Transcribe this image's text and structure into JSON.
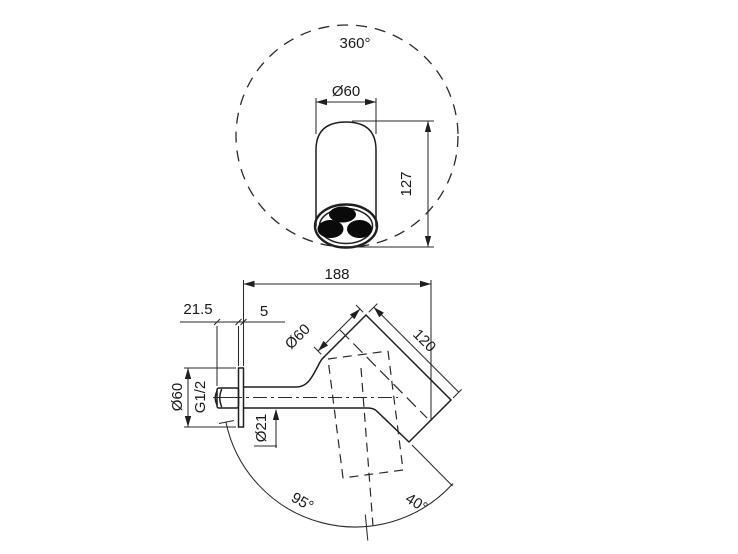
{
  "page": {
    "background_color": "#ffffff",
    "line_color": "#1f1f1f",
    "description": "technical-dimension-drawing"
  },
  "top_view": {
    "rotation_angle": "360°",
    "head_diameter": "Ø60",
    "head_height": "127"
  },
  "side_view": {
    "total_projection": "188",
    "wall_inset": "21.5",
    "plate_thickness": "5",
    "head_diameter": "Ø60",
    "head_length": "120",
    "plate_diameter": "Ø60",
    "thread_size": "G1/2",
    "arm_diameter": "Ø21",
    "swivel_range": "95°",
    "tilt_angle": "40°"
  }
}
